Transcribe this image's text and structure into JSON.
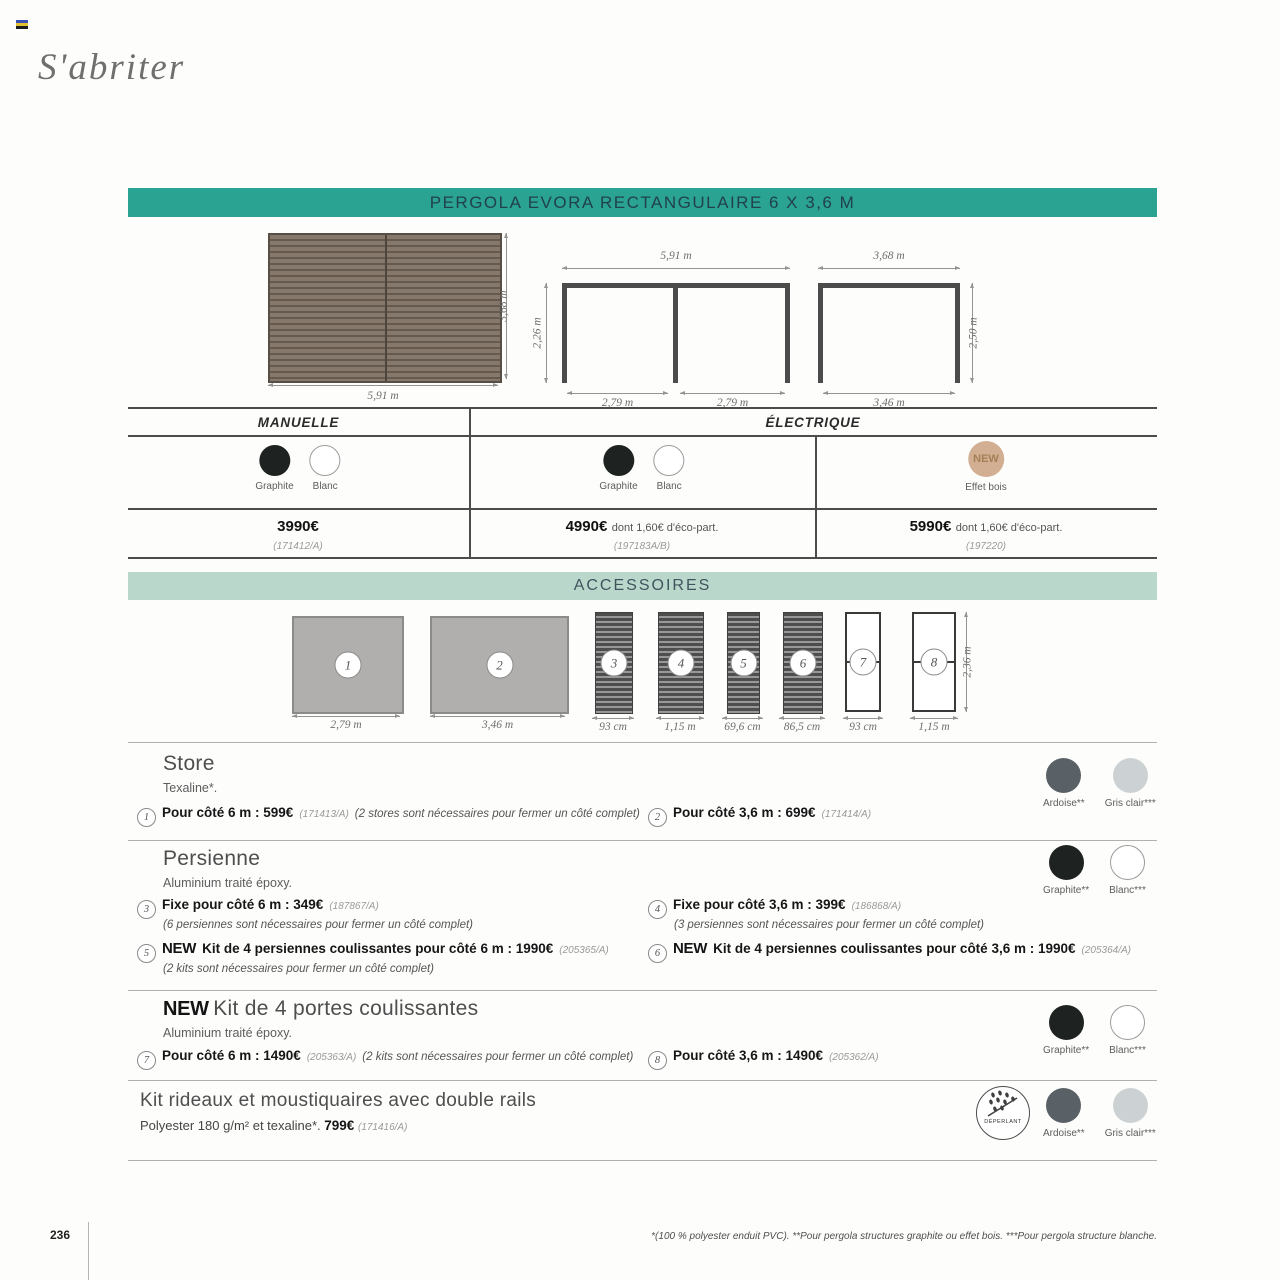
{
  "header": {
    "script_title": "S'abriter"
  },
  "banner": {
    "title": "PERGOLA EVORA RECTANGULAIRE 6 X 3,6 M"
  },
  "diagrams": {
    "top_view": {
      "width": "5,91 m",
      "height": "3,68 m"
    },
    "front_view": {
      "top_width": "5,91 m",
      "height": "2,26 m",
      "span_left": "2,79 m",
      "span_right": "2,79 m"
    },
    "side_view": {
      "top_width": "3,68 m",
      "height": "2,50 m",
      "bottom_width": "3,46 m"
    }
  },
  "pricing": {
    "manual_header": "MANUELLE",
    "electric_header": "ÉLECTRIQUE",
    "cols": [
      {
        "swatches": [
          {
            "label": "Graphite"
          },
          {
            "label": "Blanc"
          }
        ],
        "price": "3990€",
        "suffix": "",
        "ref": "(171412/A)"
      },
      {
        "swatches": [
          {
            "label": "Graphite"
          },
          {
            "label": "Blanc"
          }
        ],
        "price": "4990€",
        "suffix": "dont 1,60€ d'éco-part.",
        "ref": "(197183A/B)"
      },
      {
        "new_badge": "NEW",
        "swatch_label": "Effet bois",
        "price": "5990€",
        "suffix": "dont 1,60€ d'éco-part.",
        "ref": "(197220)"
      }
    ]
  },
  "accessories": {
    "banner": "ACCESSOIRES",
    "height_label": "2,36 m",
    "items": [
      {
        "num": "1",
        "dim": "2,79 m"
      },
      {
        "num": "2",
        "dim": "3,46 m"
      },
      {
        "num": "3",
        "dim": "93 cm"
      },
      {
        "num": "4",
        "dim": "1,15 m"
      },
      {
        "num": "5",
        "dim": "69,6 cm"
      },
      {
        "num": "6",
        "dim": "86,5 cm"
      },
      {
        "num": "7",
        "dim": "93 cm"
      },
      {
        "num": "8",
        "dim": "1,15 m"
      }
    ]
  },
  "store": {
    "title": "Store",
    "subtitle": "Texaline*.",
    "items": [
      {
        "num": "1",
        "bold": "Pour côté 6 m : 599€",
        "ref": "(171413/A)",
        "note": "(2 stores sont nécessaires pour fermer un côté complet)"
      },
      {
        "num": "2",
        "bold": "Pour côté 3,6 m : 699€",
        "ref": "(171414/A)"
      }
    ],
    "swatches": [
      {
        "label": "Ardoise**"
      },
      {
        "label": "Gris clair***"
      }
    ]
  },
  "persienne": {
    "title": "Persienne",
    "subtitle": "Aluminium traité époxy.",
    "items": [
      {
        "num": "3",
        "bold": "Fixe pour côté 6 m : 349€",
        "ref": "(187867/A)",
        "note": "(6 persiennes sont nécessaires pour fermer un côté complet)"
      },
      {
        "num": "4",
        "bold": "Fixe pour côté 3,6 m : 399€",
        "ref": "(186868/A)",
        "note": "(3 persiennes sont nécessaires pour fermer un côté complet)"
      },
      {
        "num": "5",
        "new": "NEW",
        "bold": "Kit de 4 persiennes coulissantes pour côté 6 m : 1990€",
        "ref": "(205365/A)",
        "note": "(2 kits sont nécessaires pour fermer un côté complet)"
      },
      {
        "num": "6",
        "new": "NEW",
        "bold": "Kit de 4 persiennes coulissantes pour côté 3,6 m : 1990€",
        "ref": "(205364/A)"
      }
    ],
    "swatches": [
      {
        "label": "Graphite**"
      },
      {
        "label": "Blanc***"
      }
    ]
  },
  "portes": {
    "new": "NEW",
    "title": "Kit de 4 portes coulissantes",
    "subtitle": "Aluminium traité époxy.",
    "items": [
      {
        "num": "7",
        "bold": "Pour côté 6 m : 1490€",
        "ref": "(205363/A)",
        "note": "(2 kits sont nécessaires pour fermer un côté complet)"
      },
      {
        "num": "8",
        "bold": "Pour côté 3,6 m : 1490€",
        "ref": "(205362/A)"
      }
    ],
    "swatches": [
      {
        "label": "Graphite**"
      },
      {
        "label": "Blanc***"
      }
    ]
  },
  "rideaux": {
    "title": "Kit rideaux et moustiquaires avec double rails",
    "desc": "Polyester 180 g/m² et texaline*.",
    "price": "799€",
    "ref": "(171416/A)",
    "badge": "DÉPERLANT",
    "swatches": [
      {
        "label": "Ardoise**"
      },
      {
        "label": "Gris clair***"
      }
    ]
  },
  "footer": {
    "page_number": "236",
    "footnote": "*(100 % polyester enduit PVC).  **Pour pergola structures graphite ou effet bois. ***Pour pergola structure blanche."
  },
  "colors": {
    "teal_banner": "#2aa392",
    "mint_banner": "#bad7cc",
    "graphite": "#1e2220",
    "blanc": "#ffffff",
    "ardoise": "#5a6166",
    "gris_clair": "#ccd2d3",
    "effet_bois": "#d2ae92"
  }
}
